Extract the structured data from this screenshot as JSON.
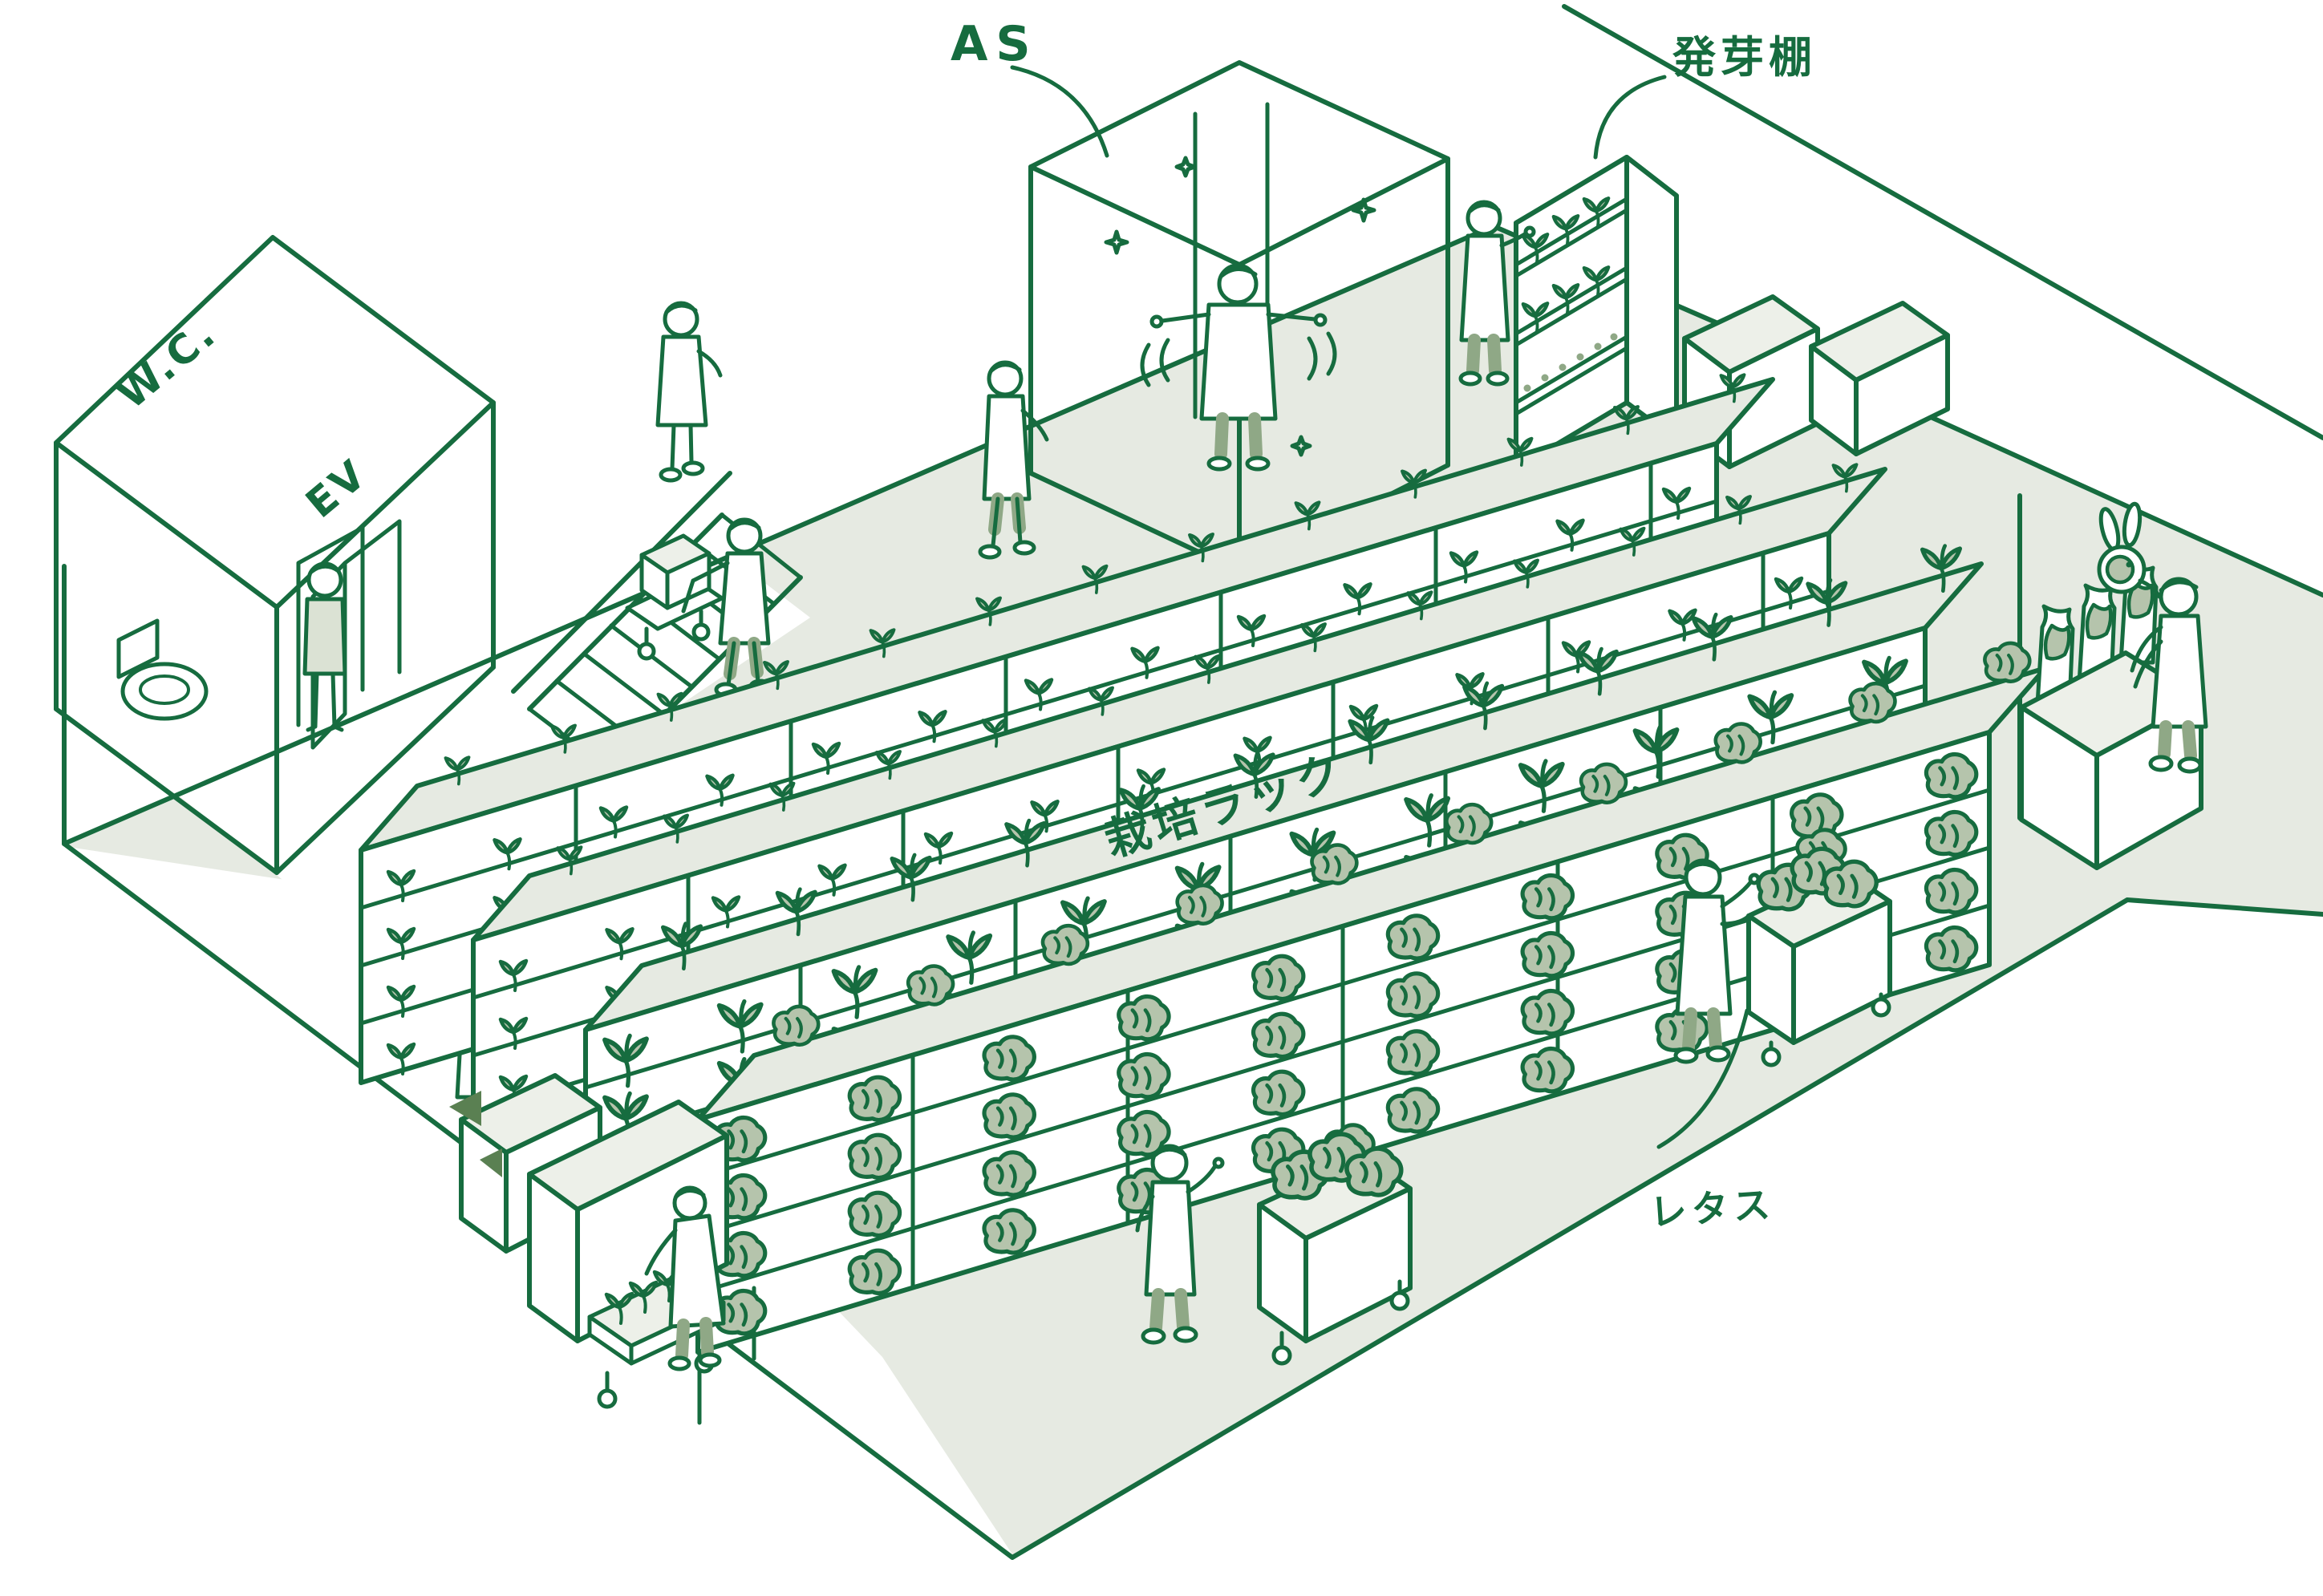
{
  "labels": {
    "air_shower": "AS",
    "germination_shelf": "発芽棚",
    "toilet": "W.C.",
    "elevator": "EV",
    "cultivation_rack": "栽培ラック",
    "lettuce": "レタス"
  },
  "colors": {
    "line": "#166c3f",
    "floor": "#e6eae2",
    "surface": "#edf0e9",
    "plant": "#b5c4ac",
    "plant_dark": "#8fa886",
    "accent_dark": "#5a8052",
    "background": "#ffffff"
  },
  "scene": {
    "racks": [
      {
        "name": "cultivation-rack-1",
        "stage": "seedling",
        "rows": 4,
        "cols": 13,
        "top_cols": 13
      },
      {
        "name": "cultivation-rack-2",
        "stage": "seedling",
        "rows": 4,
        "cols": 13,
        "top_cols": 13
      },
      {
        "name": "cultivation-rack-3",
        "stage": "young",
        "rows": 4,
        "cols": 12,
        "top_cols": 12
      },
      {
        "name": "cultivation-rack-4",
        "stage": "lettuce",
        "rows": 4,
        "cols": 10,
        "top_cols": 10
      }
    ],
    "people": [
      "standing-at-elevator",
      "climbing-stairs",
      "walking-corridor",
      "pushing-cart",
      "in-air-shower",
      "tending-germination-shelf",
      "tending-rack",
      "loading-seedling-cart",
      "harvesting-center",
      "harvesting-right",
      "packing-lettuce"
    ],
    "animals": [
      "rabbit"
    ]
  }
}
